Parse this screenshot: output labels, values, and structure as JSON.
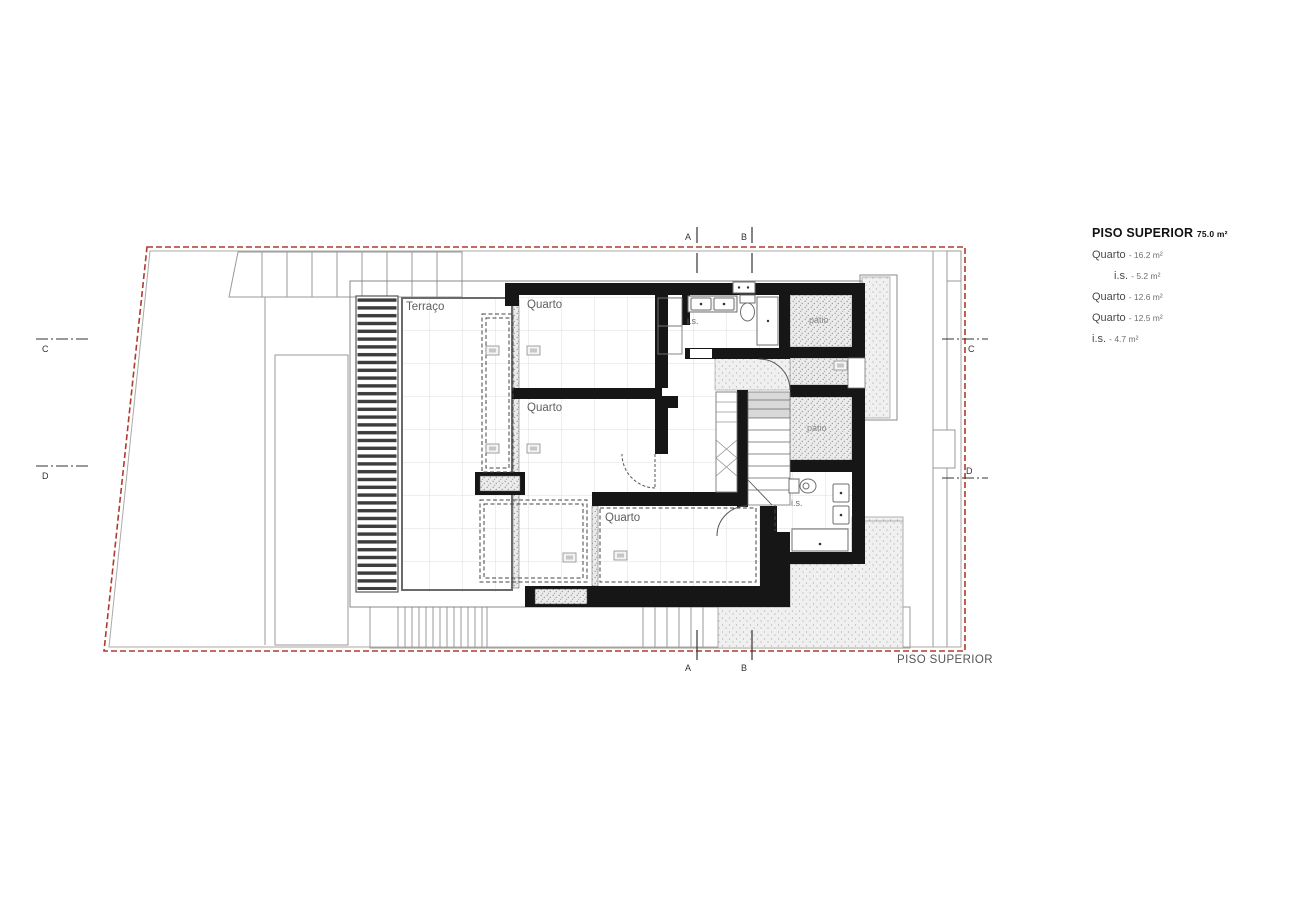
{
  "legend": {
    "title": "PISO SUPERIOR",
    "title_area": "75.0 m²",
    "items": [
      {
        "name": "Quarto",
        "value": "- 16.2 m²"
      },
      {
        "name": "i.s.",
        "value": "- 5.2 m²"
      },
      {
        "name": "Quarto",
        "value": "- 12.6 m²"
      },
      {
        "name": "Quarto",
        "value": "- 12.5 m²"
      },
      {
        "name": "i.s.",
        "value": "- 4.7 m²"
      }
    ]
  },
  "caption": "PISO SUPERIOR",
  "rooms": {
    "terrace": "Terraço",
    "bedroom1": "Quarto",
    "bedroom2": "Quarto",
    "bedroom3": "Quarto",
    "bath1": "i.s.",
    "bath2": "i.s.",
    "patio1": "pátio",
    "patio2": "pátio"
  },
  "sections": {
    "a": "A",
    "b": "B",
    "c": "C",
    "d": "D"
  },
  "colors": {
    "boundary_red": "#b03a2e",
    "wall_black": "#161616",
    "thin_line_gray": "#8c8c8c",
    "grid_gray": "#dcdcdc",
    "label_gray": "#5f5f5f"
  }
}
